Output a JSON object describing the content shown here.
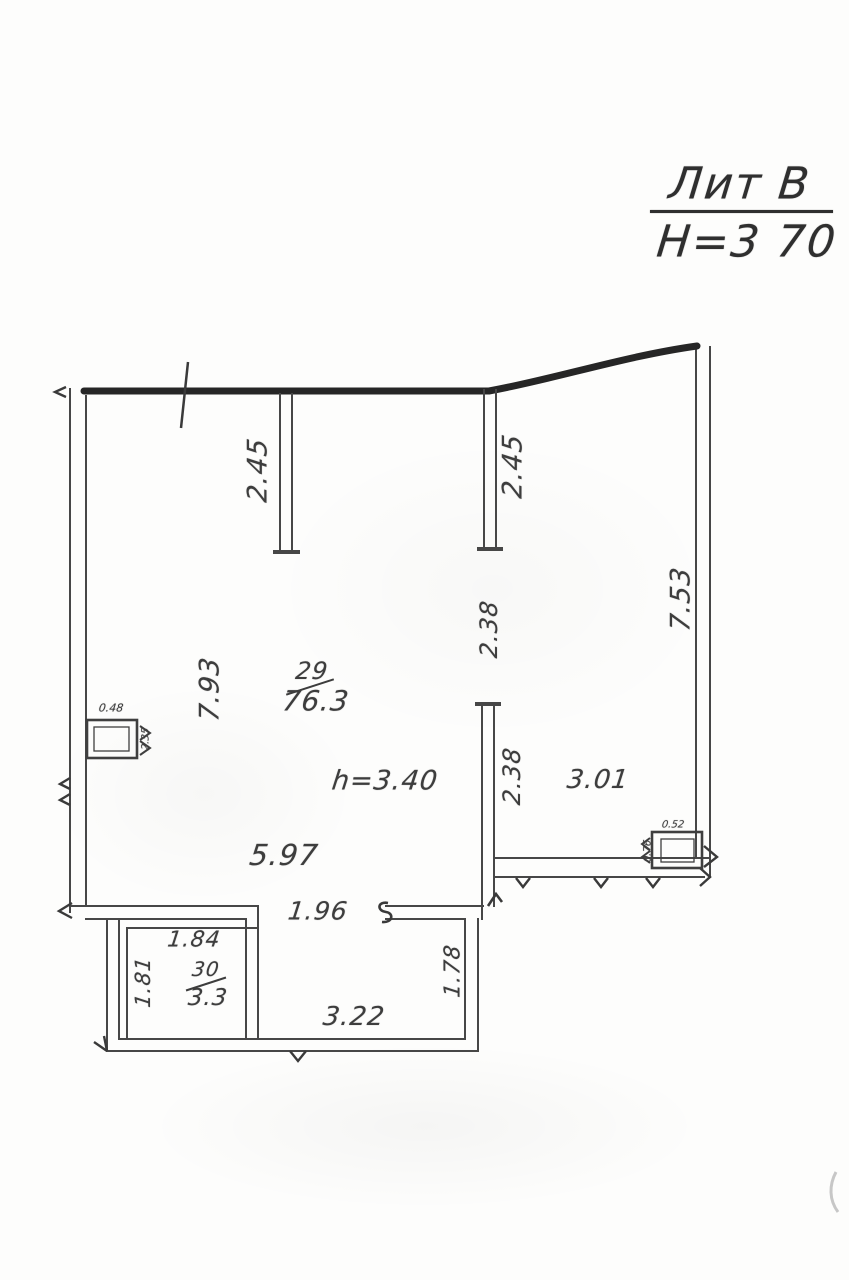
{
  "document": {
    "litera": "Лит В",
    "height_note": "Н=3 70"
  },
  "rooms": {
    "main": {
      "number": "29",
      "area": "76.3",
      "ceiling": "h=3.40"
    },
    "annex": {
      "number": "30",
      "area": "3.3"
    }
  },
  "dimensions": {
    "partition_left": "2.45",
    "partition_right": "2.45",
    "left_wall": "7.93",
    "right_wall": "7.53",
    "opening_upper": "2.38",
    "opening_lower": "2.38",
    "right_room_width": "3.01",
    "main_room_width": "5.97",
    "doorway_width": "1.96",
    "annex_room_top": "1.84",
    "annex_room_left": "1.81",
    "annex_width": "3.22",
    "annex_right": "1.78",
    "vent_left_width": "0.48",
    "vent_left_height": "2.35",
    "vent_right_width": "0.52",
    "vent_right_height": "0.76"
  },
  "colors": {
    "paper": "#fdfdfc",
    "wall_thick": "#262626",
    "wall_thin": "#474747",
    "ink": "#3d3d3d"
  }
}
